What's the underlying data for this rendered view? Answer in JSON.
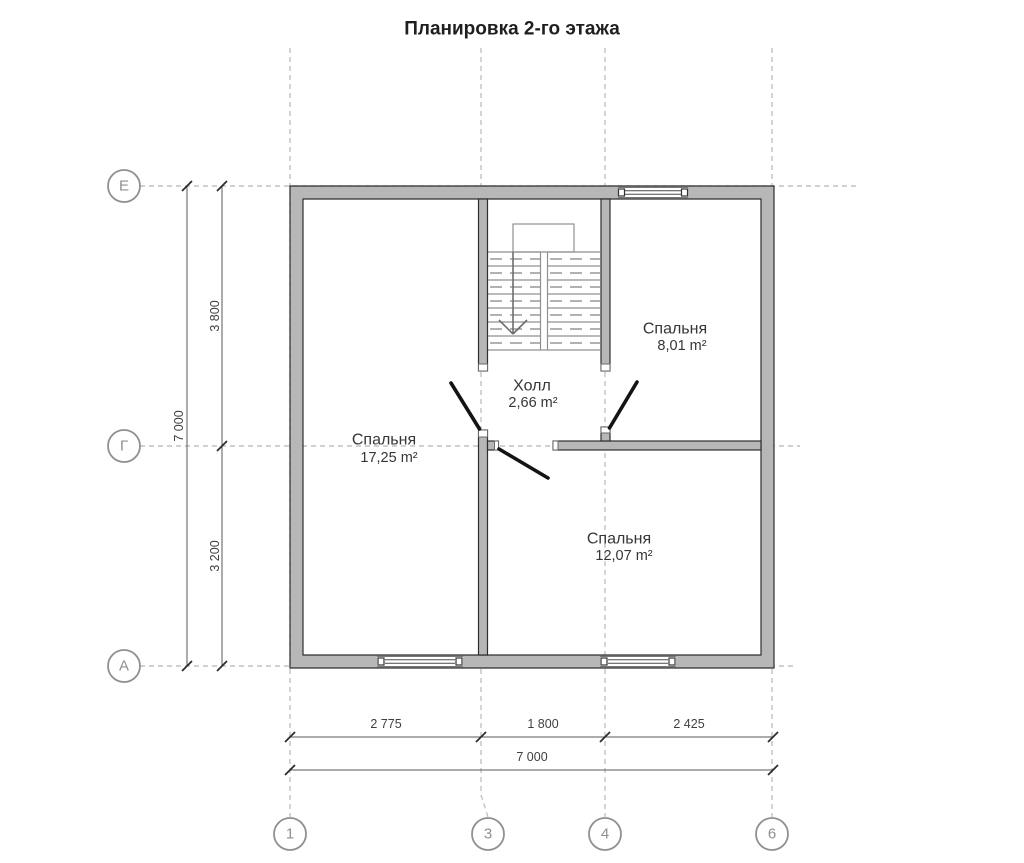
{
  "title": "Планировка 2-го этажа",
  "rooms": [
    {
      "name": "Спальня",
      "area": "17,25 m²"
    },
    {
      "name": "Холл",
      "area": "2,66 m²"
    },
    {
      "name": "Спальня",
      "area": "8,01 m²"
    },
    {
      "name": "Спальня",
      "area": "12,07 m²"
    }
  ],
  "axes": {
    "row_labels": [
      "Е",
      "Г",
      "А"
    ],
    "column_labels": [
      "1",
      "3",
      "4",
      "6"
    ]
  },
  "dimensions": {
    "left": {
      "total": "7 000",
      "upper": "3 800",
      "lower": "3 200"
    },
    "bottom": {
      "segments": [
        "2 775",
        "1 800",
        "2 425"
      ],
      "total": "7 000"
    }
  },
  "colors": {
    "wall_fill": "#b7b7b7",
    "wall_outline": "#2e2e2e",
    "door": "#141414",
    "axis_dash": "#c2c2c2",
    "dimension_text": "#3f3f3f",
    "axis_label": "#8f8f8f",
    "stair_line": "#909090"
  }
}
